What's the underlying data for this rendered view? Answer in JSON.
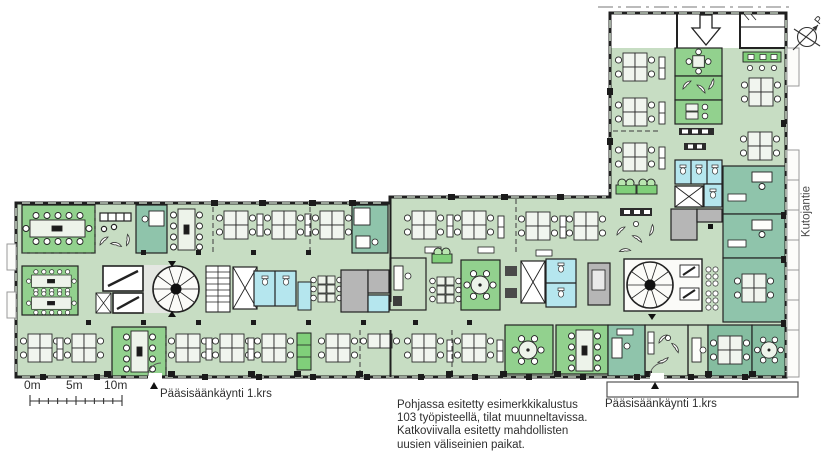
{
  "texts": {
    "note_line1": "Pohjassa esitetty esimerkkikalustus",
    "note_line2": "103 työpisteellä, tilat muunneltavissa.",
    "note_line3": "Katkoviivalla esitetty mahdollisten",
    "note_line4": "uusien väliseinien paikat.",
    "entrance_left": "Pääsisäänkäynti 1.krs",
    "entrance_right": "Pääsisäänkäynti 1.krs",
    "street": "Kutojantie",
    "north_mark": "P",
    "scale_tick_0": "0m",
    "scale_tick_5": "5m",
    "scale_tick_10": "10m"
  },
  "colors": {
    "floor_open_office": "#c7ddc3",
    "meeting_room_green": "#92d18e",
    "office_teal": "#8fc4ab",
    "wc_cyan": "#b5e6ee",
    "technical_gray": "#b6b6b6",
    "cabinet_green": "#80cf7a",
    "wall_black": "#1f1f1f",
    "background": "#ffffff"
  }
}
